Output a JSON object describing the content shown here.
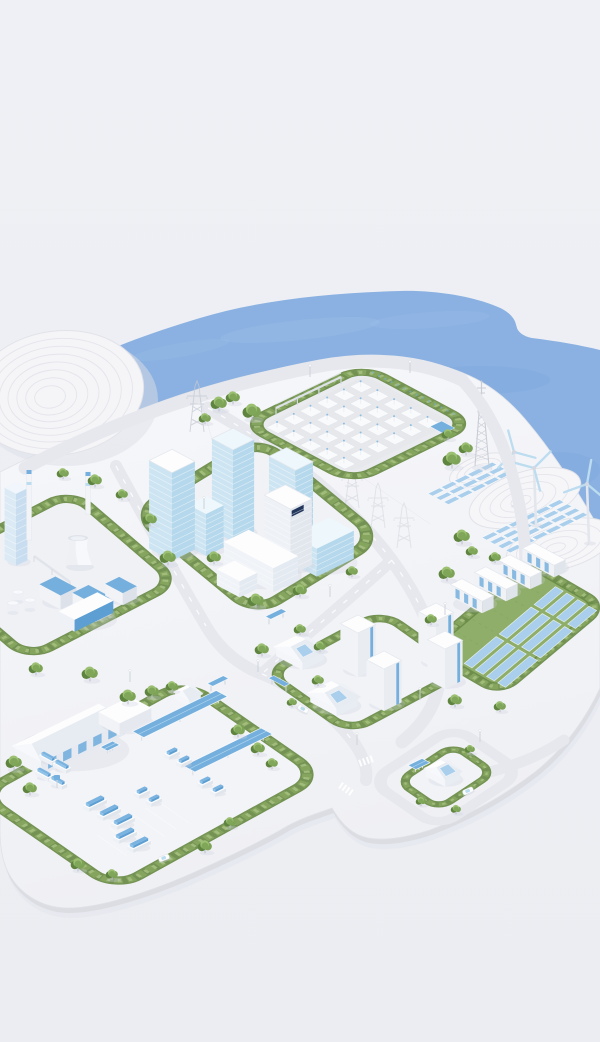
{
  "meta": {
    "title": "Isometric smart city energy island",
    "description": "3D isometric illustration of a coastal smart city model with power, mobility and renewable energy districts on a white platform surrounded by water"
  },
  "palette": {
    "bg": "#eef0f5",
    "bgBottom": "#ebedf2",
    "water": "#8ab1e1",
    "waterDeep": "#7aa2d4",
    "waterLight": "#a3c3ec",
    "land": "#f5f6f9",
    "landLow": "#eff0f4",
    "landEdge": "#d8dae1",
    "landShadow": "#e3e5ec",
    "road": "#e6e8ee",
    "roadLine": "#ffffff",
    "mound": "#f5f5f8",
    "contour": "#e2e3e9",
    "hedgeDark": "#6b8c4a",
    "hedgeMid": "#85a55f",
    "hedgeLight": "#a5bf80",
    "treeDark": "#5f8440",
    "treeMid": "#7da357",
    "treeLight": "#9cc072",
    "trunk": "#b9bec7",
    "white": "#fdfdfe",
    "wallLight": "#f1f3f7",
    "wallShade": "#dde2ea",
    "glassTop": "#eef7fb",
    "glassLeft": "#cde5f2",
    "glassRight": "#b5d8ec",
    "accent": "#74afdd",
    "accentDark": "#5d9fd3",
    "panel": "#a9cfec",
    "panelLight": "#bcdcf0",
    "steel": "#c6cad3",
    "concrete": "#e9ebef",
    "concreteDark": "#e4e6ea",
    "grass": "#8fae6a",
    "grassDark": "#7a9a55",
    "navy": "#22365c",
    "shadow": "#ccd2dd"
  },
  "scene": {
    "water_label": "Coastal water",
    "mound_label": "Terraced white hill",
    "coast_label": "Shore with wind turbines and solar terraces",
    "districts": {
      "substation": {
        "label": "High-voltage substation district"
      },
      "industrial": {
        "label": "Industrial plant district"
      },
      "downtown": {
        "label": "Downtown high-rise district"
      },
      "battery": {
        "label": "Solar farm and battery storage district"
      },
      "residential": {
        "label": "Residential district"
      },
      "depot": {
        "label": "Bus depot and logistics district"
      },
      "ev": {
        "label": "EV charging block"
      }
    },
    "counts": {
      "wind_turbines": 3,
      "battery_containers": 4,
      "residential_towers": 4,
      "houses": 2,
      "transmission_pylons": 5
    }
  }
}
